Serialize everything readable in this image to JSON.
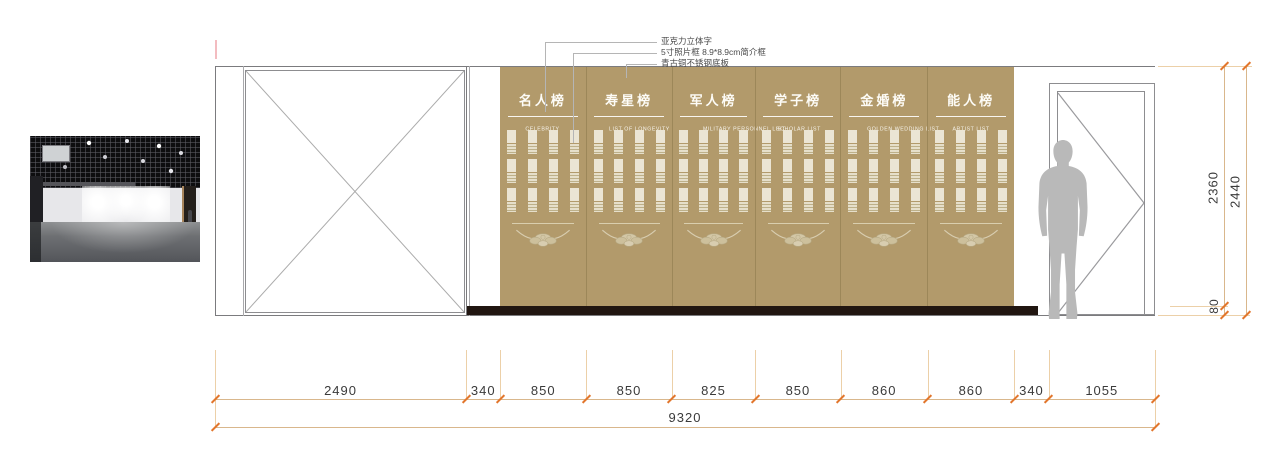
{
  "annotations": {
    "items": [
      "亚克力立体字",
      "5寸照片框 8.9*8.9cm简介框",
      "青古铜不锈钢底板"
    ]
  },
  "panels": [
    {
      "title": "名人榜",
      "subtitle": "CELEBRITY",
      "width_mm": 850
    },
    {
      "title": "寿星榜",
      "subtitle": "LIST OF LONGEVITY",
      "width_mm": 850
    },
    {
      "title": "军人榜",
      "subtitle": "MILITARY PERSONNEL LIST",
      "width_mm": 825
    },
    {
      "title": "学子榜",
      "subtitle": "SCHOLAR LIST",
      "width_mm": 850
    },
    {
      "title": "金婚榜",
      "subtitle": "GOLDEN WEDDING LIST",
      "width_mm": 860
    },
    {
      "title": "能人榜",
      "subtitle": "ARTIST LIST",
      "width_mm": 860
    }
  ],
  "panel_grid": {
    "columns": 4,
    "rows": 3
  },
  "dimensions": {
    "bottom_segments_mm": [
      2490,
      340,
      850,
      850,
      825,
      850,
      860,
      860,
      340,
      1055
    ],
    "bottom_total_mm": 9320,
    "right_inner_mm": 2360,
    "right_outer_mm": 2440,
    "baseboard_mm": 80
  },
  "colors": {
    "wall_gold": "#b29a6b",
    "photo_frame_cream": "#ebe5d4",
    "baseboard_dark": "#211611",
    "dimension_line": "#d9b78c",
    "dimension_tick": "#e2762c",
    "dimension_text": "#3a3a3a",
    "silhouette_gray": "#b9b9b9",
    "panel_text": "#ffffff"
  }
}
